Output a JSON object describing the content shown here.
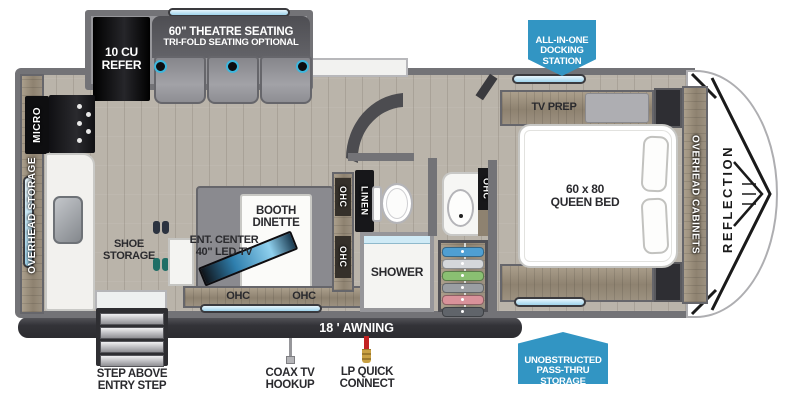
{
  "brand": "REFLECTION",
  "badges": {
    "docking_station": "ALL-IN-ONE\nDOCKING\nSTATION",
    "pass_thru": "UNOBSTRUCTED\nPASS-THRU\nSTORAGE"
  },
  "exterior": {
    "awning": "18 ' AWNING",
    "coax": "COAX TV\nHOOKUP",
    "lp_quick_connect": "LP QUICK\nCONNECT",
    "entry_step": "STEP ABOVE\nENTRY STEP"
  },
  "slideout": {
    "refrigerator": "10 CU\nREFER",
    "theatre_seating": "60\" THEATRE SEATING",
    "theatre_seating_sub": "TRI-FOLD SEATING OPTIONAL"
  },
  "kitchen": {
    "microwave": "MICRO",
    "overhead_storage": "OVERHEAD STORAGE",
    "shoe_storage": "SHOE\nSTORAGE"
  },
  "living": {
    "booth_dinette": "BOOTH\nDINETTE",
    "ent_center": "ENT. CENTER\n40\" LED TV",
    "ohc_left": "OHC",
    "ohc_right": "OHC",
    "ohc_upper": "OHC",
    "ohc_lower": "OHC"
  },
  "bathroom": {
    "linen": "LINEN",
    "shower": "SHOWER",
    "ohc_vanity": "OHC"
  },
  "bedroom": {
    "tv_prep": "TV PREP",
    "queen_bed": "60 x 80\nQUEEN BED",
    "overhead_cabinets": "OVERHEAD CABINETS"
  },
  "colors": {
    "badge_blue": "#3295c3",
    "wall_gray": "#737377",
    "window_blue": "#a9d9ee",
    "wood_tan": "#9c9180",
    "awning_dark": "#3a3a3e"
  }
}
